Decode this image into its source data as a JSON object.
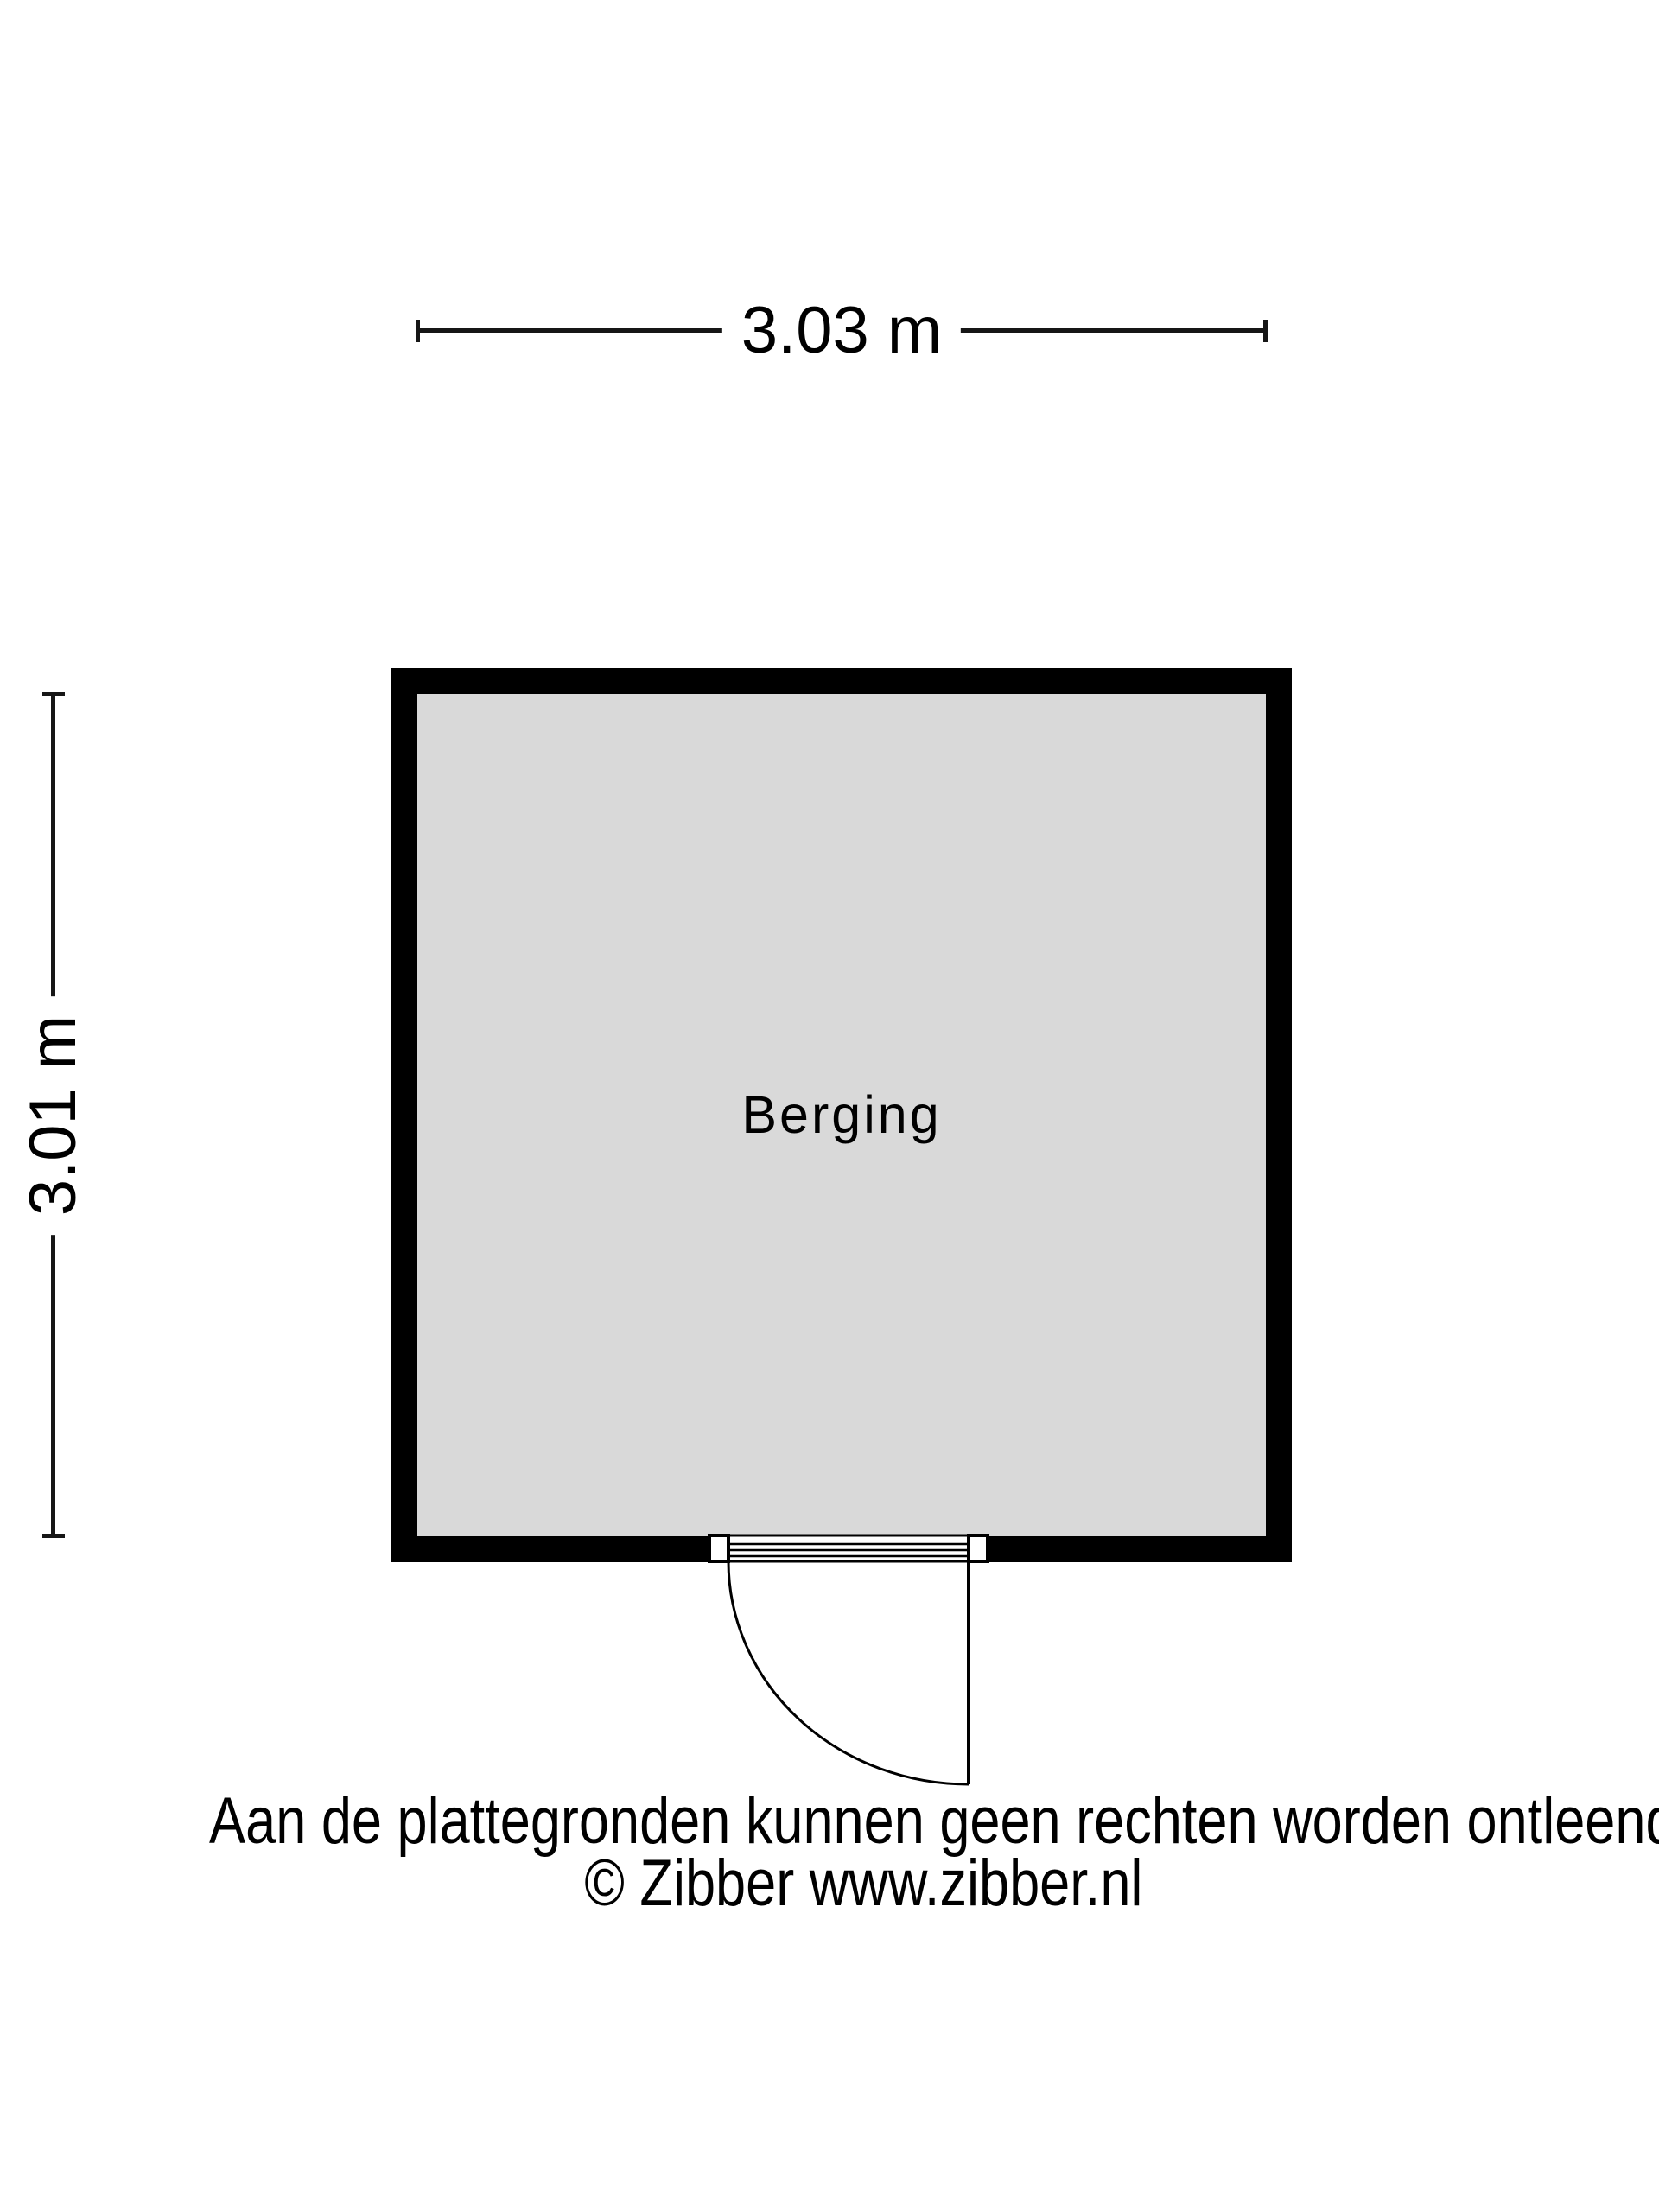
{
  "floor_plan": {
    "room": {
      "label": "Berging",
      "fill_color": "#d9d9d9",
      "wall_color": "#000000"
    },
    "dimensions": {
      "width_label": "3.03 m",
      "height_label": "3.01 m"
    }
  },
  "footer": {
    "disclaimer": "Aan de plattegronden kunnen geen rechten worden ontleend",
    "copyright": "© Zibber www.zibber.nl"
  },
  "colors": {
    "background": "#ffffff",
    "wall": "#000000",
    "room_fill": "#d9d9d9",
    "line": "#161616",
    "text": "#000000"
  }
}
